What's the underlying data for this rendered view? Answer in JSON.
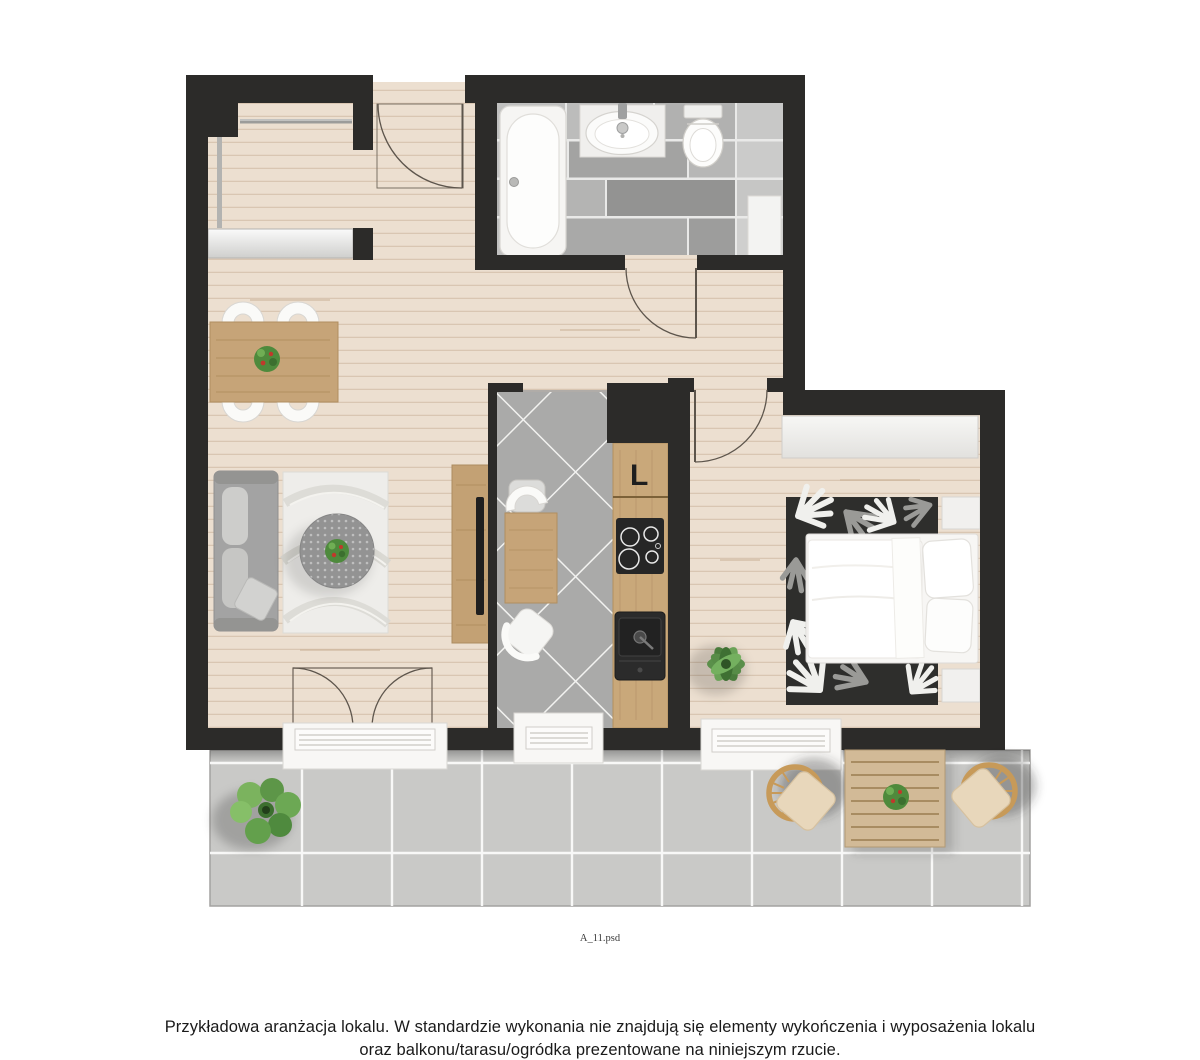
{
  "plan": {
    "fridge_label": "L",
    "file_label": "A_11.psd"
  },
  "disclaimer": {
    "line1": "Przykładowa aranżacja lokalu. W standardzie wykonania nie znajdują się elementy wykończenia i wyposażenia lokalu",
    "line2": "oraz balkonu/tarasu/ogródka prezentowane na niniejszym rzucie."
  },
  "palette": {
    "wall": "#2c2b29",
    "wood_floor": "#ecdfd0",
    "plank_line": "#d9c6b2",
    "bath_tile": "#b0b0af",
    "kitchen_tile": "#aaaaa9",
    "balcony_tile": "#c9c9c7",
    "counter_wood": "#c9a87a",
    "dining_wood": "#c6a478",
    "outdoor_wood": "#d2ba97",
    "fixture_white": "#f8f7f5",
    "sofa_gray": "#a3a3a3",
    "rug_dark": "#2e2e2c",
    "plant_green": "#4e8a3c",
    "wicker_tan": "#c79a59",
    "cushion_beige": "#e8d7bb",
    "text_color": "#1a1a1a"
  }
}
